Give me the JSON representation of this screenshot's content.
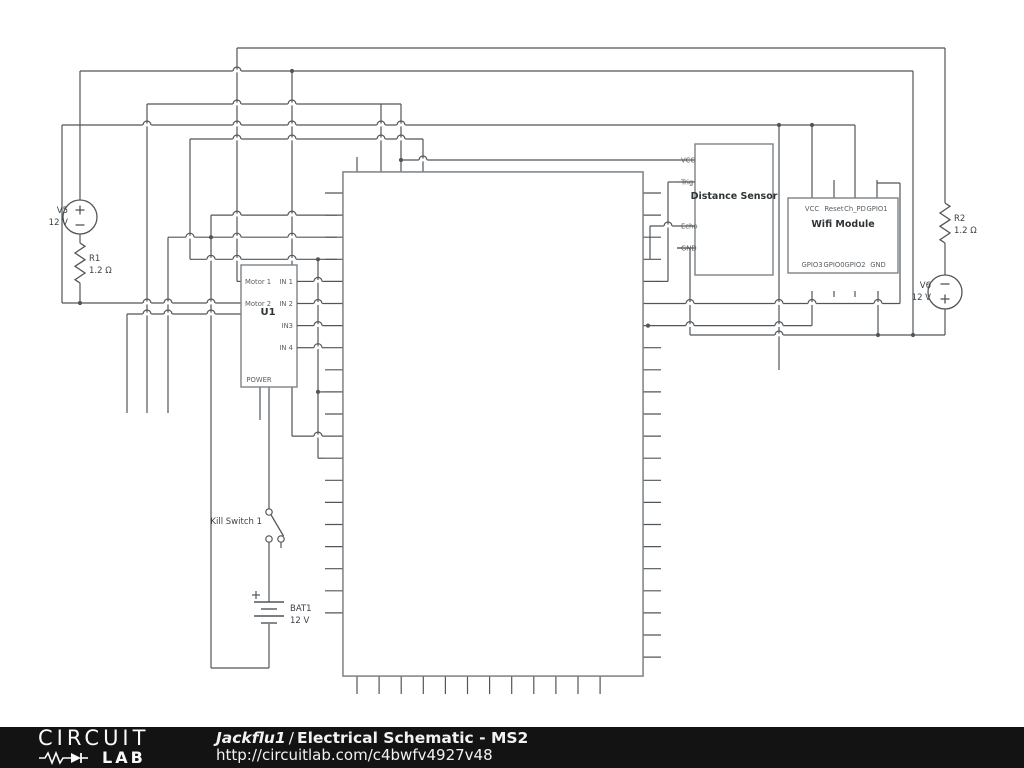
{
  "colors": {
    "canvas_bg": "#ffffff",
    "wire": "#51565a",
    "box_stroke": "#7d8286",
    "pin_text": "#585e62",
    "label_text": "#3d4246",
    "title_text": "#2e3336",
    "footer_bg": "#131313",
    "footer_text": "#f2f2f2"
  },
  "schematic": {
    "arduino": {
      "title": "Arduino Mega",
      "top_pins": [
        "IOREF",
        "3.3V",
        "5V",
        "Vin"
      ],
      "left_pins": [
        "RESET",
        "GND",
        "GND",
        "GND",
        "A0",
        "A1",
        "A2",
        "A3",
        "A4",
        "A5",
        "A6",
        "A7",
        "A8",
        "A9",
        "A10",
        "A11",
        "A12",
        "A13",
        "A14",
        "A15"
      ],
      "right_pins": [
        "13",
        "12",
        "11",
        "~10",
        "~9",
        "~8",
        "7",
        "~6",
        "~5",
        "4",
        "~3",
        "2",
        "TX -> 1",
        "RX <- ~0",
        "14",
        "15",
        "16",
        "17",
        "18",
        "19",
        "20",
        "21"
      ],
      "bottom_pins": [
        "52",
        "50",
        "48",
        "46",
        "44",
        "42",
        "40",
        "38",
        "36",
        "34",
        "32",
        "30"
      ]
    },
    "u1": {
      "ref": "U1",
      "left_pins": [
        "Motor 1",
        "Motor 2"
      ],
      "right_pins": [
        "IN 1",
        "IN 2",
        "IN3",
        "IN 4"
      ],
      "bottom_pins": [
        "POWER"
      ]
    },
    "distance_sensor": {
      "title": "Distance Sensor",
      "left_pins": [
        "VCC",
        "Trig",
        "Echo",
        "GND"
      ]
    },
    "wifi_module": {
      "title": "Wifi Module",
      "top_pins": [
        "VCC",
        "Reset",
        "Ch_PD",
        "GPIO1"
      ],
      "bottom_pins": [
        "GPIO3",
        "GPIO0",
        "GPIO2",
        "GND"
      ]
    },
    "v5": {
      "ref": "V5",
      "value": "12 V"
    },
    "v6": {
      "ref": "V6",
      "value": "12 V"
    },
    "r1": {
      "ref": "R1",
      "value": "1.2 Ω"
    },
    "r2": {
      "ref": "R2",
      "value": "1.2 Ω"
    },
    "bat1": {
      "ref": "BAT1",
      "value": "12 V"
    },
    "kill_switch": {
      "label": "Kill Switch 1"
    }
  },
  "footer": {
    "logo_top": "CIRCUIT",
    "logo_bottom": "LAB",
    "author": "Jackflu1",
    "separator": "/",
    "title": "Electrical Schematic - MS2",
    "url": "http://circuitlab.com/c4bwfv4927v48"
  }
}
